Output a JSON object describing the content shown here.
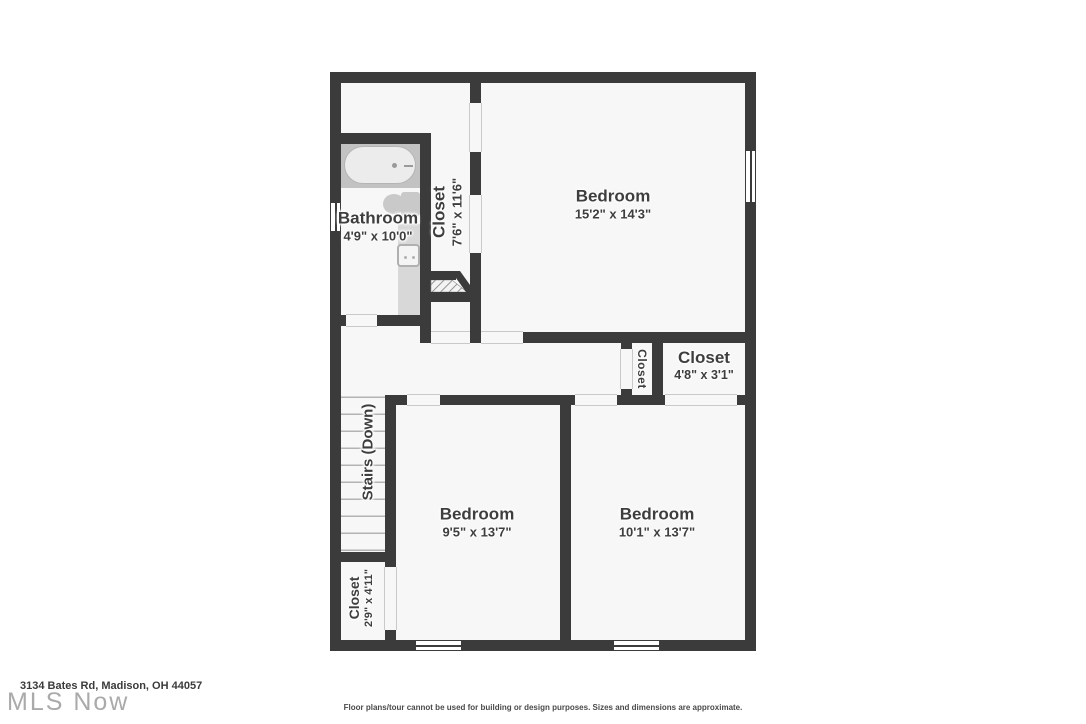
{
  "plan": {
    "rooms": {
      "bathroom": {
        "name": "Bathroom",
        "dims": "4'9\" x 10'0\""
      },
      "closet_upper": {
        "name": "Closet",
        "dims": "7'6\" x 11'6\""
      },
      "bedroom_top": {
        "name": "Bedroom",
        "dims": "15'2\" x 14'3\""
      },
      "closet_hall_small": {
        "name": "Closet"
      },
      "closet_hall": {
        "name": "Closet",
        "dims": "4'8\" x 3'1\""
      },
      "stairs": {
        "name": "Stairs (Down)"
      },
      "closet_bottom": {
        "name": "Closet",
        "dims": "2'9\" x 4'11\""
      },
      "bedroom_left": {
        "name": "Bedroom",
        "dims": "9'5\" x 13'7\""
      },
      "bedroom_right": {
        "name": "Bedroom",
        "dims": "10'1\" x 13'7\""
      }
    },
    "fixtures": [
      "bathtub",
      "toilet",
      "sink-vanity",
      "stair-treads",
      "under-stair-hatch"
    ]
  },
  "footer": {
    "address": "3134 Bates Rd, Madison, OH 44057",
    "watermark": "MLS Now",
    "disclaimer": "Floor plans/tour cannot be used for building or design purposes. Sizes and dimensions are approximate."
  },
  "colors": {
    "wall": "#3b3b3b",
    "floor": "#f7f7f7",
    "fixture": "#c9c9c9",
    "text": "#3e3e3e",
    "watermark": "#aaaaaa"
  }
}
